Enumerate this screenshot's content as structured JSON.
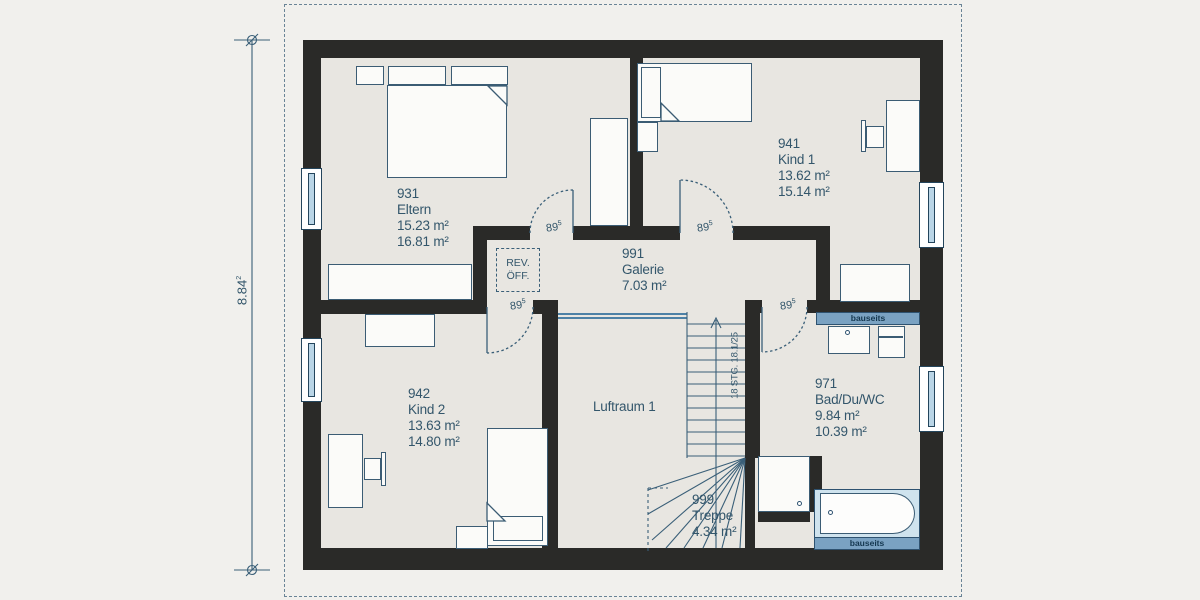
{
  "labels": {
    "eltern": {
      "id": "931",
      "name": "Eltern",
      "area1": "15.23 m²",
      "area2": "16.81 m²"
    },
    "kind1": {
      "id": "941",
      "name": "Kind 1",
      "area1": "13.62 m²",
      "area2": "15.14 m²"
    },
    "kind2": {
      "id": "942",
      "name": "Kind 2",
      "area1": "13.63 m²",
      "area2": "14.80 m²"
    },
    "galerie": {
      "id": "991",
      "name": "Galerie",
      "area1": "7.03 m²"
    },
    "bad": {
      "id": "971",
      "name": "Bad/Du/WC",
      "area1": "9.84 m²",
      "area2": "10.39 m²"
    },
    "treppe": {
      "id": "999",
      "name": "Treppe",
      "area1": "4.34 m²"
    },
    "luftraum": {
      "name": "Luftraum 1"
    }
  },
  "annotations": {
    "door_width": "89",
    "door_width_sup": "5",
    "dimension_value": "8.84",
    "dimension_sup": "2",
    "stair_note": "18 STG. 18.1/25",
    "rev_line1": "REV.",
    "rev_line2": "ÖFF.",
    "bauseits_top": "bauseits",
    "bauseits_bottom": "bauseits"
  },
  "colors": {
    "background": "#f1f0ed",
    "floor": "#e8e6e1",
    "wall": "#2a2a28",
    "label_text": "#33566b",
    "line_accent": "#3a5f78",
    "window_glass": "#bad5e6",
    "bauseits_bar": "#7aa2c2",
    "railing": "#4d81a6"
  }
}
